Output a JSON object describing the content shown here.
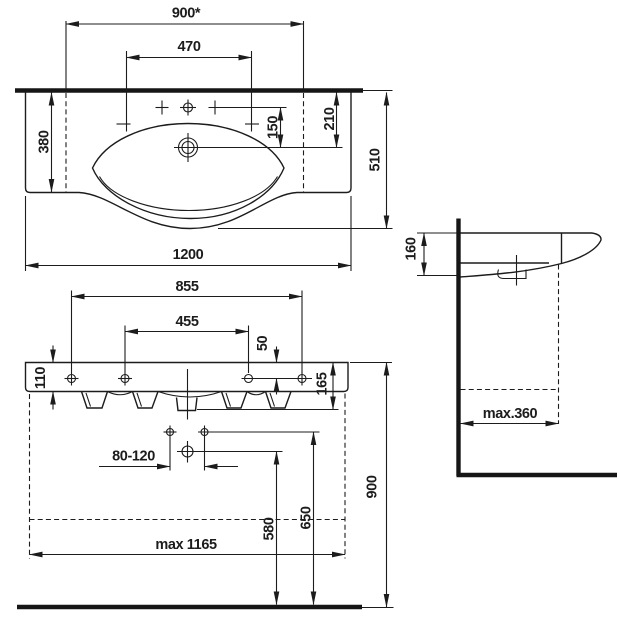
{
  "drawing": {
    "ink_color": "#1c1c1c",
    "background_color": "#ffffff",
    "views": {
      "top": {
        "labels": {
          "wall_fixing_width": "900*",
          "faucet_hole_spacing": "470",
          "side_depth": "380",
          "faucet_to_drain": "150",
          "wall_to_drain": "210",
          "overall_depth": "510",
          "overall_width": "1200"
        }
      },
      "front": {
        "labels": {
          "fixing_hole_spacing_outer": "855",
          "fixing_hole_spacing_inner": "455",
          "rim_to_fixing_holes": "50",
          "apron_height": "110",
          "total_height": "165",
          "drain_offset_range": "80-120",
          "drain_outlet_height": "580",
          "supply_height": "650",
          "rim_height": "900",
          "max_clearance_width": "max 1165"
        }
      },
      "side": {
        "labels": {
          "front_edge_height": "160",
          "max_wall_clearance": "max.360"
        }
      }
    }
  }
}
